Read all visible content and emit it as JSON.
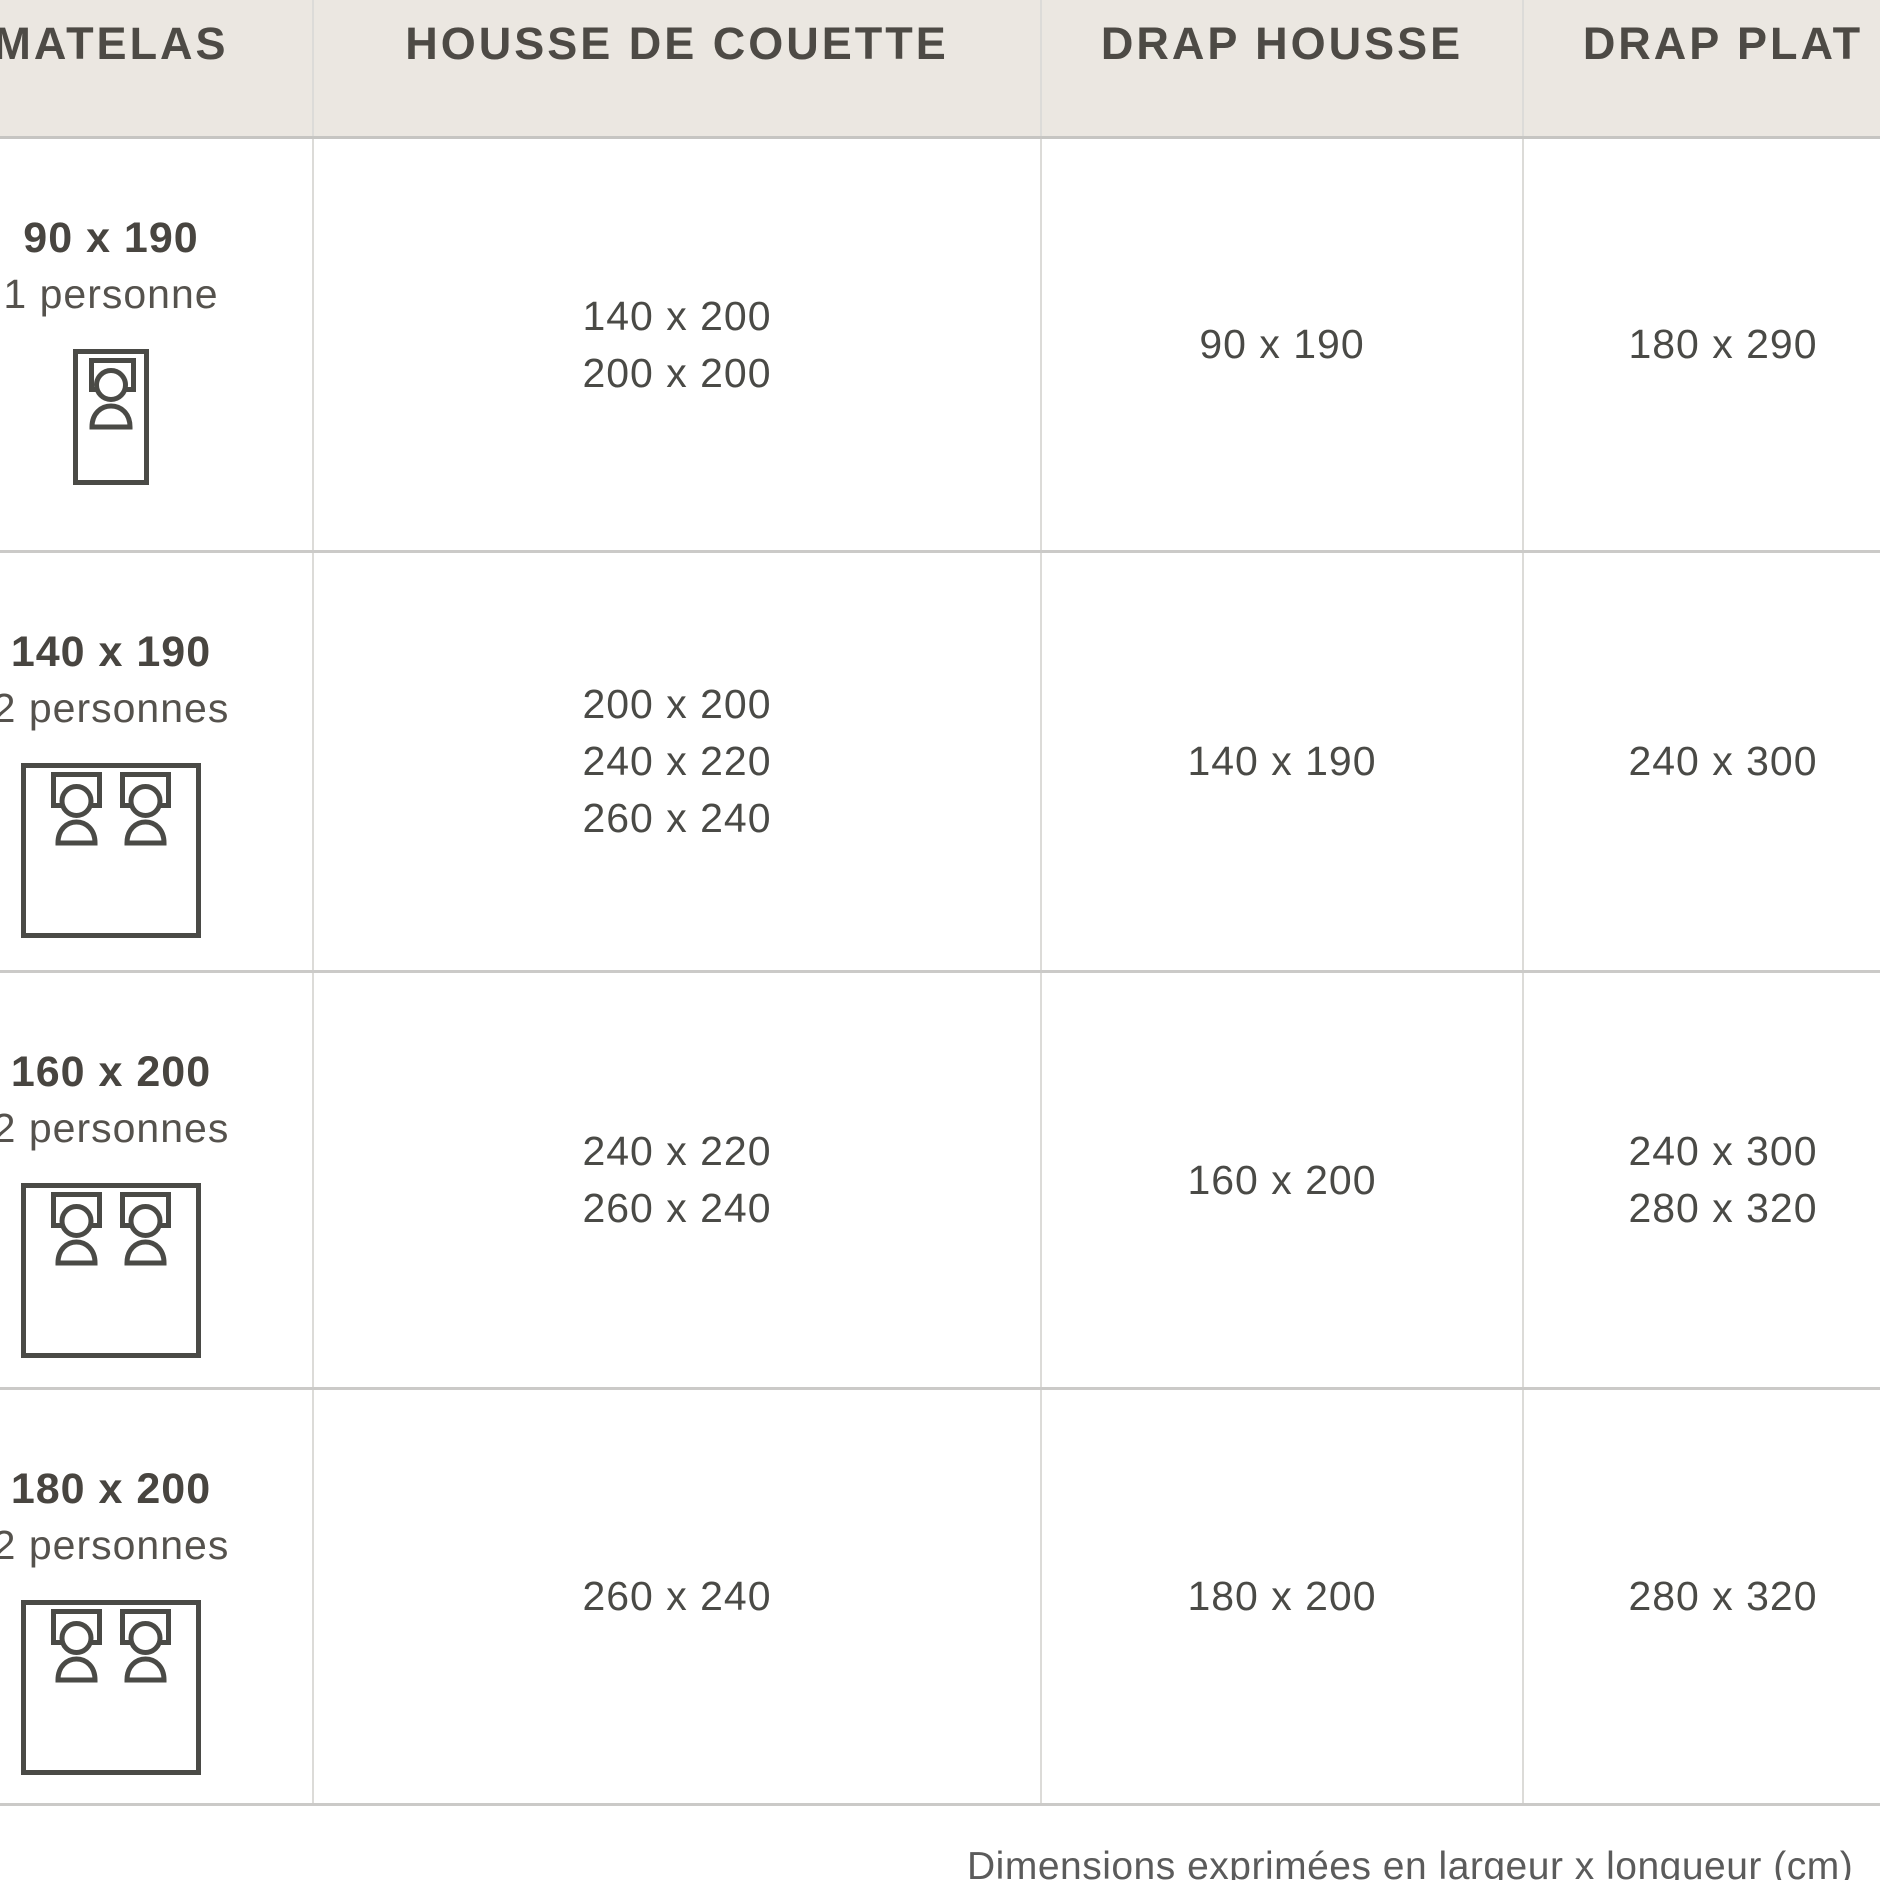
{
  "table": {
    "columns": [
      {
        "key": "matelas",
        "label": "MATELAS"
      },
      {
        "key": "housse_de_couette",
        "label": "HOUSSE DE COUETTE"
      },
      {
        "key": "drap_housse",
        "label": "DRAP HOUSSE"
      },
      {
        "key": "drap_plat",
        "label": "DRAP PLAT"
      }
    ],
    "rows": [
      {
        "matelas_size": "90 x 190",
        "persons": "1 personne",
        "bed_icon": "bed-single-icon",
        "housse": [
          "140 x 200",
          "200 x 200"
        ],
        "drap_housse": [
          "90 x 190"
        ],
        "drap_plat": [
          "180 x 290"
        ]
      },
      {
        "matelas_size": "140 x 190",
        "persons": "2 personnes",
        "bed_icon": "bed-double-icon",
        "housse": [
          "200 x 200",
          "240 x 220",
          "260 x 240"
        ],
        "drap_housse": [
          "140 x 190"
        ],
        "drap_plat": [
          "240 x 300"
        ]
      },
      {
        "matelas_size": "160 x 200",
        "persons": "2 personnes",
        "bed_icon": "bed-double-icon",
        "housse": [
          "240 x 220",
          "260 x 240"
        ],
        "drap_housse": [
          "160 x 200"
        ],
        "drap_plat": [
          "240 x 300",
          "280 x 320"
        ]
      },
      {
        "matelas_size": "180 x 200",
        "persons": "2 personnes",
        "bed_icon": "bed-double-icon",
        "housse": [
          "260 x 240"
        ],
        "drap_housse": [
          "180 x 200"
        ],
        "drap_plat": [
          "280 x 320"
        ]
      }
    ]
  },
  "footer": {
    "note": "Dimensions exprimées en largeur x longueur (cm)"
  },
  "colors": {
    "header_bg": "#EBE7E1",
    "header_text": "#4D4A45",
    "cell_text": "#4A4A46",
    "divider_h": "#CBCAC8",
    "divider_v": "#DCDBD8",
    "icon_stroke": "#4A4A46"
  }
}
